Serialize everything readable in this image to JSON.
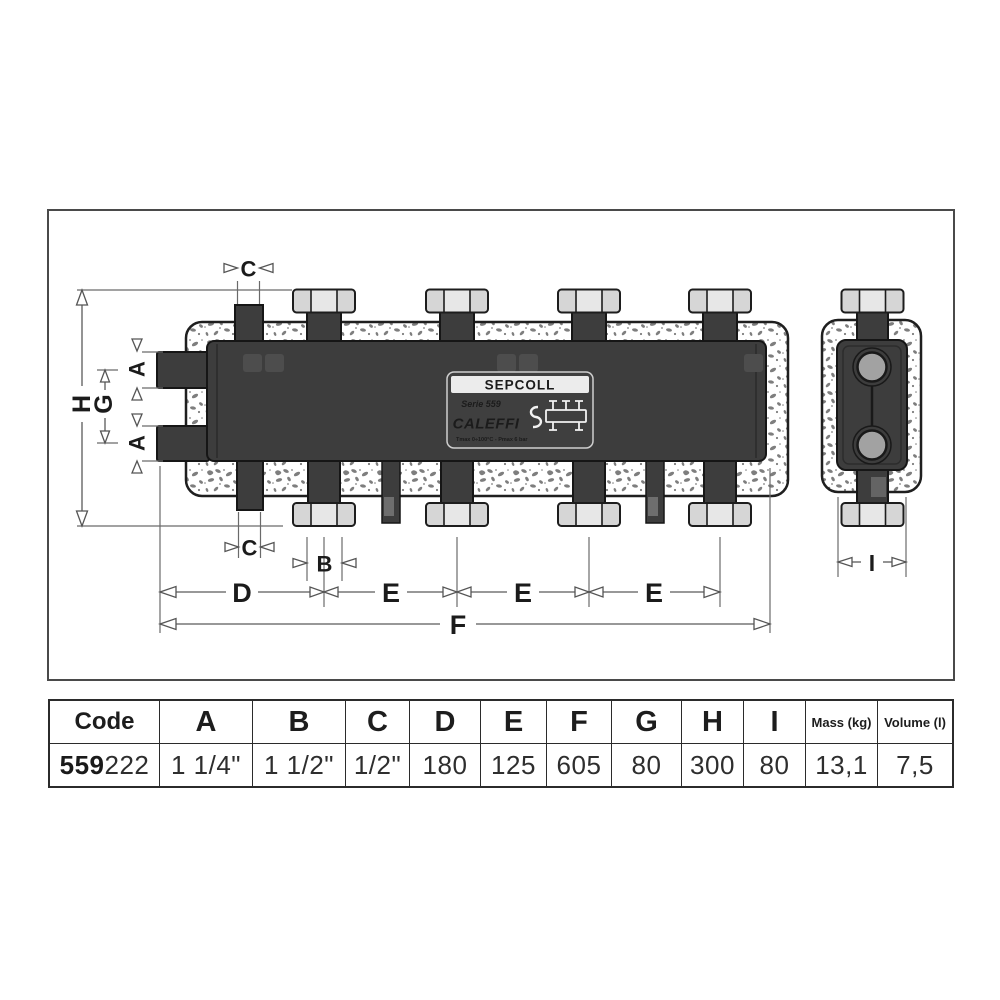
{
  "drawing": {
    "dims": {
      "A": "A",
      "B": "B",
      "C": "C",
      "D": "D",
      "E": "E",
      "F": "F",
      "G": "G",
      "H": "H",
      "I": "I"
    },
    "plate": {
      "title": "SEPCOLL",
      "series": "Serie 559",
      "brand": "CALEFFI",
      "specs": "Tmax 0÷100°C - Pmax 6 bar"
    }
  },
  "table": {
    "columns": [
      {
        "header": "Code",
        "value_bold": "559",
        "value_rest": "222"
      },
      {
        "header": "A",
        "value": "1 1/4\""
      },
      {
        "header": "B",
        "value": "1 1/2\""
      },
      {
        "header": "C",
        "value": "1/2\""
      },
      {
        "header": "D",
        "value": "180"
      },
      {
        "header": "E",
        "value": "125"
      },
      {
        "header": "F",
        "value": "605"
      },
      {
        "header": "G",
        "value": "80"
      },
      {
        "header": "H",
        "value": "300"
      },
      {
        "header": "I",
        "value": "80"
      },
      {
        "header": "Mass (kg)",
        "value": "13,1"
      },
      {
        "header": "Volume (l)",
        "value": "7,5"
      }
    ]
  }
}
